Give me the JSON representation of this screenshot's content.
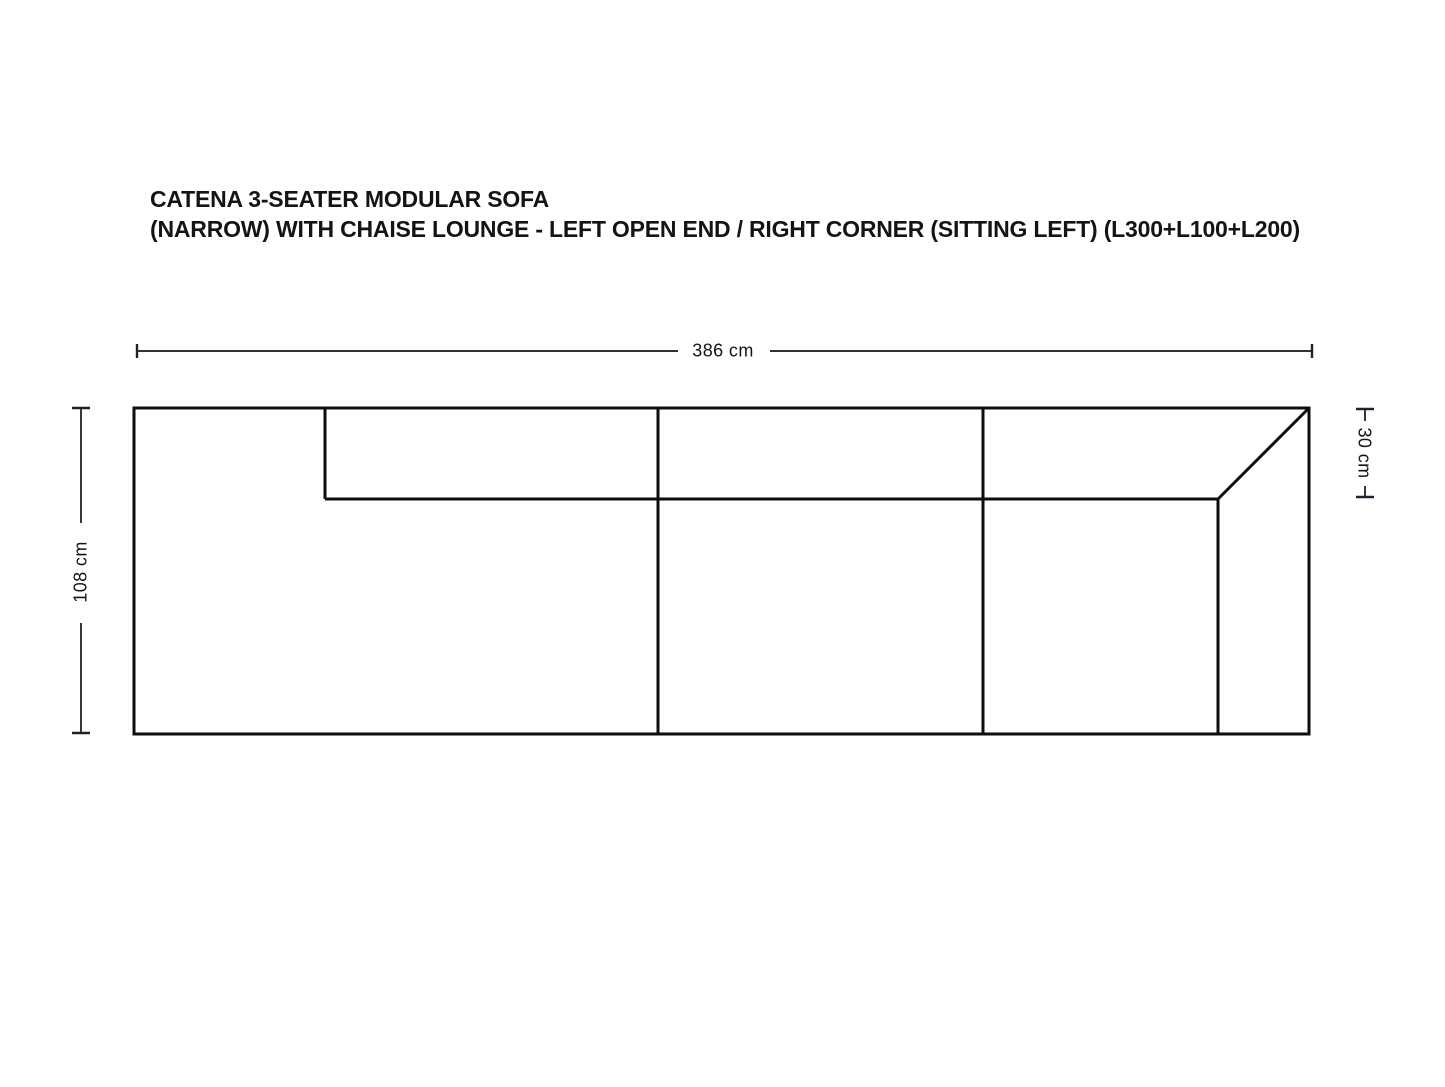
{
  "title": {
    "line1": "CATENA 3-SEATER MODULAR SOFA",
    "line2": "(NARROW) WITH CHAISE LOUNGE - LEFT OPEN END / RIGHT CORNER (SITTING LEFT) (L300+L100+L200)"
  },
  "dimensions": {
    "overall_width_label": "386 cm",
    "overall_depth_label": "108 cm",
    "backrest_depth_label": "30 cm"
  },
  "colors": {
    "background": "#ffffff",
    "sofa_line": "#0e0e0e",
    "dimension_line": "#141414",
    "text": "#141414"
  }
}
